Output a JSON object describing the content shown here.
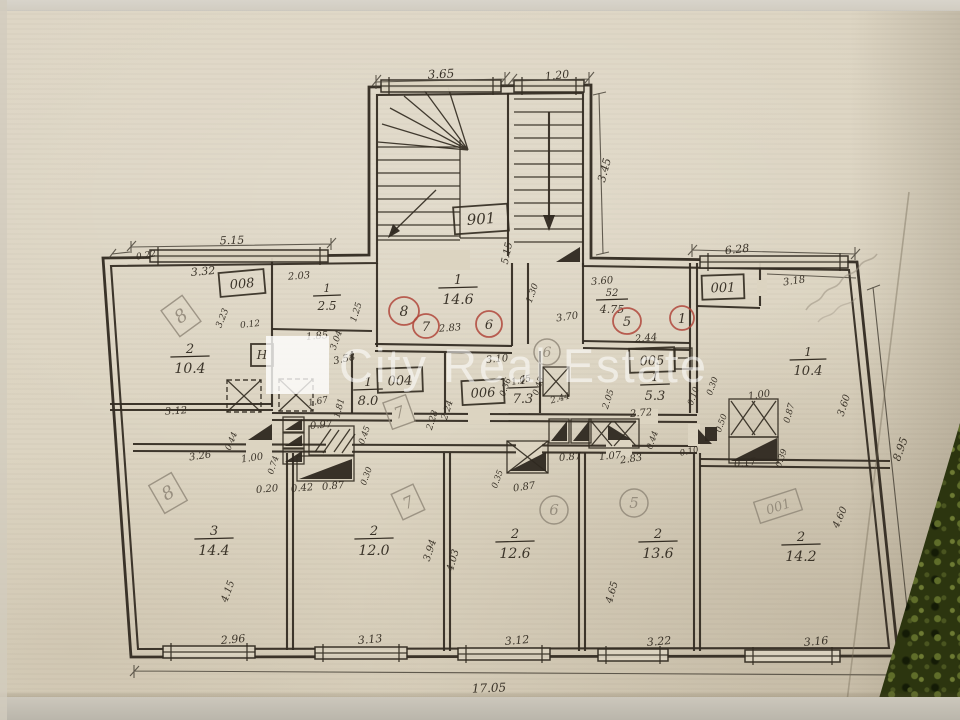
{
  "watermark": {
    "text": "City Real Estate"
  },
  "colors": {
    "paper": "#dcd4c1",
    "ink": "#332c22",
    "pencil": "#8d8475",
    "red_ink": "#b0473b",
    "watermark_white": "rgba(255,255,255,0.55)",
    "fabric_green": "#2c350f"
  },
  "plan": {
    "overall_width": "17.05",
    "stairwell_code": "901",
    "room_codes": [
      "008",
      "004",
      "006",
      "005",
      "001",
      "901"
    ],
    "apartment_marks_red": [
      "8",
      "7",
      "6",
      "5",
      "1"
    ],
    "apartment_marks_pencil": [
      "8",
      "7",
      "6",
      "5",
      "001",
      "8",
      "7"
    ],
    "rooms": [
      {
        "number": "2",
        "area": "10.4"
      },
      {
        "number": "1",
        "area": "2.5"
      },
      {
        "number": "1",
        "area": "14.6"
      },
      {
        "number": "1",
        "area": "8.0"
      },
      {
        "number": "1",
        "area": "7.3"
      },
      {
        "number": "52",
        "area": "4.75"
      },
      {
        "number": "1",
        "area": "5.3"
      },
      {
        "number": "1",
        "area": "10.4"
      },
      {
        "number": "3",
        "area": "14.4"
      },
      {
        "number": "2",
        "area": "12.0"
      },
      {
        "number": "2",
        "area": "12.6"
      },
      {
        "number": "2",
        "area": "13.6"
      },
      {
        "number": "2",
        "area": "14.2"
      }
    ]
  },
  "labels": [
    {
      "t": "3.65",
      "x": 441,
      "y": 74,
      "r": -3,
      "s": 12
    },
    {
      "t": "1.20",
      "x": 557,
      "y": 75,
      "r": -6,
      "s": 11
    },
    {
      "t": "3.45",
      "x": 604,
      "y": 170,
      "r": -75,
      "s": 11
    },
    {
      "t": "901",
      "x": 481,
      "y": 219,
      "r": -4,
      "s": 15,
      "shape": "box",
      "w": 54,
      "h": 27,
      "n": "room-code-badge"
    },
    {
      "t": "5.15",
      "x": 506,
      "y": 253,
      "r": -78,
      "s": 10
    },
    {
      "t": "5.15",
      "x": 232,
      "y": 240,
      "r": -2,
      "s": 11
    },
    {
      "t": "0.22",
      "x": 146,
      "y": 255,
      "r": -10,
      "s": 9
    },
    {
      "t": "3.32",
      "x": 203,
      "y": 271,
      "r": -5,
      "s": 11
    },
    {
      "t": "008",
      "x": 242,
      "y": 283,
      "r": -5,
      "s": 13,
      "shape": "box",
      "w": 45,
      "h": 24,
      "n": "room-code-badge"
    },
    {
      "t": "2.03",
      "x": 299,
      "y": 275,
      "r": -4,
      "s": 10
    },
    {
      "fr": {
        "top": "1",
        "bot": "2.5"
      },
      "x": 327,
      "y": 295,
      "s": 11,
      "n": "room-area-label"
    },
    {
      "t": "3.23",
      "x": 222,
      "y": 318,
      "r": -68,
      "s": 9
    },
    {
      "t": "0.12",
      "x": 250,
      "y": 324,
      "r": -6,
      "s": 9
    },
    {
      "k": "pencil",
      "t": "8",
      "x": 181,
      "y": 316,
      "r": -36,
      "s": 18,
      "shape": "box",
      "w": 26,
      "h": 32,
      "n": "pencil-apartment-mark"
    },
    {
      "fr": {
        "top": "2",
        "bot": "10.4"
      },
      "x": 190,
      "y": 356,
      "s": 13,
      "n": "room-area-label"
    },
    {
      "t": "1.85",
      "x": 317,
      "y": 335,
      "r": -5,
      "s": 10
    },
    {
      "t": "1.25",
      "x": 356,
      "y": 312,
      "r": -72,
      "s": 9
    },
    {
      "t": "H",
      "x": 262,
      "y": 355,
      "s": 12,
      "shape": "box",
      "w": 22,
      "h": 22,
      "n": "radiator-badge"
    },
    {
      "t": "3.12",
      "x": 176,
      "y": 410,
      "r": -4,
      "s": 10
    },
    {
      "k": "red",
      "t": "8",
      "x": 404,
      "y": 311,
      "s": 14,
      "shape": "circle",
      "rx": 15,
      "ry": 14,
      "n": "apartment-number-mark"
    },
    {
      "fr": {
        "top": "1",
        "bot": "14.6"
      },
      "x": 458,
      "y": 287,
      "s": 13,
      "n": "room-area-label"
    },
    {
      "k": "red",
      "t": "7",
      "x": 426,
      "y": 326,
      "s": 13,
      "shape": "circle",
      "rx": 13,
      "ry": 12,
      "n": "apartment-number-mark"
    },
    {
      "t": "2.83",
      "x": 450,
      "y": 327,
      "r": -4,
      "s": 10
    },
    {
      "k": "red",
      "t": "6",
      "x": 489,
      "y": 324,
      "s": 13,
      "shape": "circle",
      "rx": 13,
      "ry": 13,
      "n": "apartment-number-mark"
    },
    {
      "t": "1.30",
      "x": 532,
      "y": 293,
      "r": -70,
      "s": 9
    },
    {
      "t": "3.70",
      "x": 567,
      "y": 316,
      "r": -8,
      "s": 10
    },
    {
      "t": "3.60",
      "x": 602,
      "y": 280,
      "r": -5,
      "s": 10
    },
    {
      "fr": {
        "top": "52",
        "bot": "4.75"
      },
      "x": 612,
      "y": 299,
      "s": 10,
      "n": "room-area-label"
    },
    {
      "k": "red",
      "t": "5",
      "x": 627,
      "y": 321,
      "s": 13,
      "shape": "circle",
      "rx": 14,
      "ry": 13,
      "n": "apartment-number-mark"
    },
    {
      "k": "red",
      "t": "1",
      "x": 682,
      "y": 318,
      "s": 13,
      "shape": "circle",
      "rx": 12,
      "ry": 12,
      "n": "apartment-number-mark"
    },
    {
      "t": "2.44",
      "x": 646,
      "y": 337,
      "r": -5,
      "s": 10
    },
    {
      "t": "3.58",
      "x": 344,
      "y": 358,
      "r": -12,
      "s": 10
    },
    {
      "t": "3.04",
      "x": 336,
      "y": 340,
      "r": -70,
      "s": 9
    },
    {
      "fr": {
        "top": "1",
        "bot": "8.0"
      },
      "x": 368,
      "y": 389,
      "s": 12,
      "n": "room-area-label"
    },
    {
      "t": "004",
      "x": 400,
      "y": 380,
      "r": -2,
      "s": 13,
      "shape": "box",
      "w": 45,
      "h": 24,
      "n": "room-code-badge"
    },
    {
      "k": "pencil",
      "t": "7",
      "x": 399,
      "y": 412,
      "r": -20,
      "s": 16,
      "shape": "box",
      "w": 24,
      "h": 28,
      "n": "pencil-apartment-mark"
    },
    {
      "t": "1.67",
      "x": 318,
      "y": 401,
      "r": -10,
      "s": 9
    },
    {
      "t": "1.81",
      "x": 339,
      "y": 408,
      "r": -75,
      "s": 9
    },
    {
      "t": "0.97",
      "x": 321,
      "y": 424,
      "r": -5,
      "s": 10
    },
    {
      "t": "2.28",
      "x": 432,
      "y": 420,
      "r": -72,
      "s": 9
    },
    {
      "t": "2.24",
      "x": 447,
      "y": 410,
      "r": -72,
      "s": 9
    },
    {
      "fr": {
        "top": "1",
        "bot": "7.3"
      },
      "x": 523,
      "y": 387,
      "s": 12,
      "n": "room-area-label"
    },
    {
      "t": "006",
      "x": 483,
      "y": 392,
      "r": -3,
      "s": 13,
      "shape": "box",
      "w": 42,
      "h": 24,
      "n": "room-code-badge"
    },
    {
      "t": "3.10",
      "x": 497,
      "y": 358,
      "r": -5,
      "s": 10
    },
    {
      "k": "pencil",
      "t": "6",
      "x": 547,
      "y": 352,
      "s": 14,
      "shape": "circle",
      "rx": 13,
      "ry": 13,
      "n": "pencil-apartment-mark"
    },
    {
      "t": "2.44",
      "x": 560,
      "y": 398,
      "r": -15,
      "s": 9
    },
    {
      "t": "0.36",
      "x": 505,
      "y": 387,
      "r": -70,
      "s": 8.5
    },
    {
      "t": "1.05",
      "x": 521,
      "y": 380,
      "r": -12,
      "s": 9
    },
    {
      "t": "0.45",
      "x": 538,
      "y": 386,
      "r": -70,
      "s": 8.5
    },
    {
      "t": "005",
      "x": 652,
      "y": 360,
      "r": -2,
      "s": 13,
      "shape": "box",
      "w": 45,
      "h": 24,
      "n": "room-code-badge"
    },
    {
      "fr": {
        "top": "1",
        "bot": "5.3"
      },
      "x": 655,
      "y": 384,
      "s": 12,
      "n": "room-area-label"
    },
    {
      "t": "2.72",
      "x": 641,
      "y": 412,
      "r": -5,
      "s": 10
    },
    {
      "t": "2.05",
      "x": 608,
      "y": 399,
      "r": -72,
      "s": 9
    },
    {
      "t": "0.10",
      "x": 693,
      "y": 396,
      "r": -70,
      "s": 8.5
    },
    {
      "t": "0.30",
      "x": 712,
      "y": 386,
      "r": -70,
      "s": 8.5
    },
    {
      "t": "0.50",
      "x": 721,
      "y": 423,
      "r": -70,
      "s": 8.5
    },
    {
      "t": "6.28",
      "x": 737,
      "y": 249,
      "r": -6,
      "s": 11
    },
    {
      "t": "001",
      "x": 723,
      "y": 287,
      "r": -2,
      "s": 13,
      "shape": "box",
      "w": 42,
      "h": 24,
      "n": "room-code-badge"
    },
    {
      "t": "3.18",
      "x": 794,
      "y": 280,
      "r": -8,
      "s": 10
    },
    {
      "fr": {
        "top": "1",
        "bot": "10.4"
      },
      "x": 808,
      "y": 359,
      "s": 12,
      "n": "room-area-label"
    },
    {
      "t": "1.00",
      "x": 759,
      "y": 394,
      "r": -8,
      "s": 10
    },
    {
      "t": "0.87",
      "x": 789,
      "y": 413,
      "r": -75,
      "s": 9
    },
    {
      "t": "3.60",
      "x": 843,
      "y": 405,
      "r": -72,
      "s": 10
    },
    {
      "t": "8.95",
      "x": 900,
      "y": 449,
      "r": -70,
      "s": 11
    },
    {
      "t": "0.17",
      "x": 745,
      "y": 462,
      "r": -8,
      "s": 10
    },
    {
      "t": "0.39",
      "x": 781,
      "y": 458,
      "r": -70,
      "s": 8.5
    },
    {
      "t": "0.10",
      "x": 689,
      "y": 451,
      "r": -12,
      "s": 8.5
    },
    {
      "t": "3.26",
      "x": 200,
      "y": 455,
      "r": -8,
      "s": 10
    },
    {
      "t": "0.44",
      "x": 231,
      "y": 441,
      "r": -68,
      "s": 8.5
    },
    {
      "t": "1.00",
      "x": 252,
      "y": 457,
      "r": -8,
      "s": 10
    },
    {
      "t": "0.74",
      "x": 273,
      "y": 465,
      "r": -72,
      "s": 8.5
    },
    {
      "t": "0.20",
      "x": 267,
      "y": 488,
      "r": -5,
      "s": 10
    },
    {
      "t": "0.42",
      "x": 302,
      "y": 487,
      "r": -5,
      "s": 10
    },
    {
      "t": "0.87",
      "x": 333,
      "y": 485,
      "r": -5,
      "s": 10
    },
    {
      "t": "0.45",
      "x": 364,
      "y": 435,
      "r": -70,
      "s": 8.5
    },
    {
      "t": "0.30",
      "x": 366,
      "y": 476,
      "r": -70,
      "s": 8.5
    },
    {
      "t": "0.87",
      "x": 570,
      "y": 456,
      "r": -5,
      "s": 10
    },
    {
      "t": "0.35",
      "x": 497,
      "y": 479,
      "r": -70,
      "s": 8.5
    },
    {
      "t": "0.87",
      "x": 524,
      "y": 486,
      "r": -8,
      "s": 10
    },
    {
      "t": "1.07",
      "x": 610,
      "y": 455,
      "r": -5,
      "s": 10
    },
    {
      "t": "2.83",
      "x": 631,
      "y": 458,
      "r": -8,
      "s": 10
    },
    {
      "t": "0.44",
      "x": 652,
      "y": 440,
      "r": -70,
      "s": 8.5
    },
    {
      "k": "pencil",
      "t": "8",
      "x": 168,
      "y": 493,
      "r": -30,
      "s": 18,
      "shape": "box",
      "w": 26,
      "h": 32,
      "n": "pencil-apartment-mark"
    },
    {
      "fr": {
        "top": "3",
        "bot": "14.4"
      },
      "x": 214,
      "y": 538,
      "s": 13,
      "n": "room-area-label"
    },
    {
      "t": "4.15",
      "x": 227,
      "y": 591,
      "r": -70,
      "s": 10
    },
    {
      "t": "2.96",
      "x": 233,
      "y": 639,
      "r": -5,
      "s": 11
    },
    {
      "k": "pencil",
      "t": "7",
      "x": 408,
      "y": 502,
      "r": -25,
      "s": 16,
      "shape": "box",
      "w": 24,
      "h": 28,
      "n": "pencil-apartment-mark"
    },
    {
      "fr": {
        "top": "2",
        "bot": "12.0"
      },
      "x": 374,
      "y": 538,
      "s": 13,
      "n": "room-area-label"
    },
    {
      "t": "3.94",
      "x": 429,
      "y": 550,
      "r": -72,
      "s": 10
    },
    {
      "t": "4.03",
      "x": 452,
      "y": 560,
      "r": -74,
      "s": 10
    },
    {
      "t": "3.13",
      "x": 370,
      "y": 639,
      "r": -5,
      "s": 11
    },
    {
      "k": "pencil",
      "t": "6",
      "x": 554,
      "y": 510,
      "s": 15,
      "shape": "circle",
      "rx": 14,
      "ry": 14,
      "n": "pencil-apartment-mark"
    },
    {
      "fr": {
        "top": "2",
        "bot": "12.6"
      },
      "x": 515,
      "y": 541,
      "s": 13,
      "n": "room-area-label"
    },
    {
      "t": "3.12",
      "x": 517,
      "y": 640,
      "r": -5,
      "s": 11
    },
    {
      "k": "pencil",
      "t": "5",
      "x": 634,
      "y": 503,
      "s": 15,
      "shape": "circle",
      "rx": 14,
      "ry": 14,
      "n": "pencil-apartment-mark"
    },
    {
      "fr": {
        "top": "2",
        "bot": "13.6"
      },
      "x": 658,
      "y": 541,
      "s": 13,
      "n": "room-area-label"
    },
    {
      "t": "4.65",
      "x": 611,
      "y": 592,
      "r": -74,
      "s": 10
    },
    {
      "t": "3.22",
      "x": 659,
      "y": 641,
      "r": -5,
      "s": 11
    },
    {
      "k": "pencil",
      "t": "001",
      "x": 778,
      "y": 506,
      "r": -18,
      "s": 13,
      "shape": "box",
      "w": 44,
      "h": 22,
      "n": "pencil-apartment-mark"
    },
    {
      "fr": {
        "top": "2",
        "bot": "14.2"
      },
      "x": 801,
      "y": 544,
      "s": 13,
      "n": "room-area-label"
    },
    {
      "t": "4.60",
      "x": 839,
      "y": 517,
      "r": -66,
      "s": 10
    },
    {
      "t": "3.16",
      "x": 816,
      "y": 641,
      "r": -5,
      "s": 11
    },
    {
      "t": "17.05",
      "x": 489,
      "y": 688,
      "r": -2,
      "s": 12
    }
  ]
}
